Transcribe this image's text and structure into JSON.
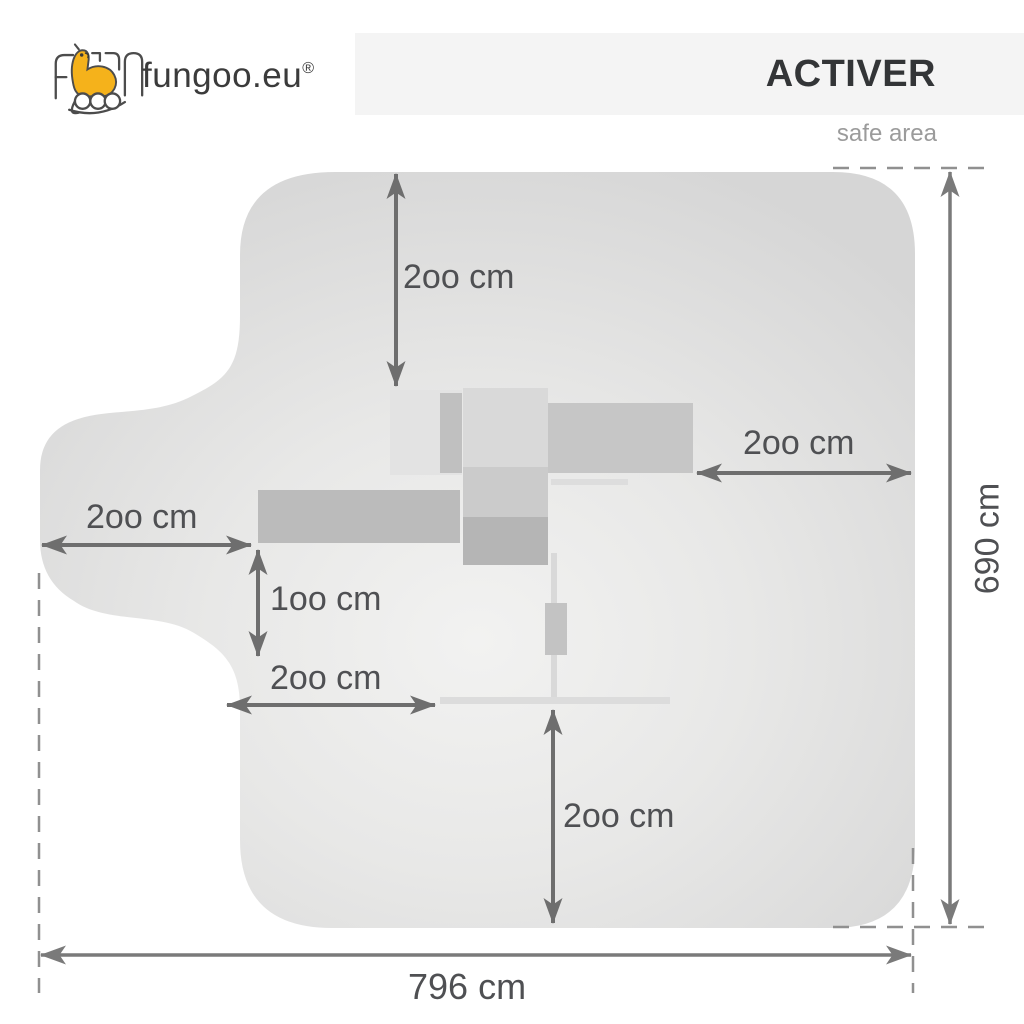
{
  "header": {
    "brand": "fungoo.eu",
    "brand_reg_mark": "®",
    "product_title": "ACTIVER",
    "subtitle": "safe area"
  },
  "diagram": {
    "labels": {
      "top_clearance": "2oo cm",
      "right_clearance": "2oo cm",
      "left_clearance": "2oo cm",
      "left_small_clearance": "1oo cm",
      "left_lower_clearance": "2oo cm",
      "bottom_clearance": "2oo cm",
      "total_height": "690 cm",
      "total_width": "796 cm"
    }
  },
  "icons": {
    "fungoo-mascot-icon": "yellow giraffe mascot inside outlined FUN letters with wheel-like goo letters"
  },
  "colors": {
    "header_bar": "#f4f4f4",
    "title_text": "#333537",
    "subtitle_text": "#9b9b9b",
    "label_text": "#4f5053",
    "arrow": "#6e6e6e",
    "dimension_line": "#7a7a7a",
    "dashed_line": "#909090",
    "safe_area_edge": "#d6d6d6",
    "safe_area_center": "#f2f2f1",
    "mascot_yellow": "#f5b21b"
  }
}
